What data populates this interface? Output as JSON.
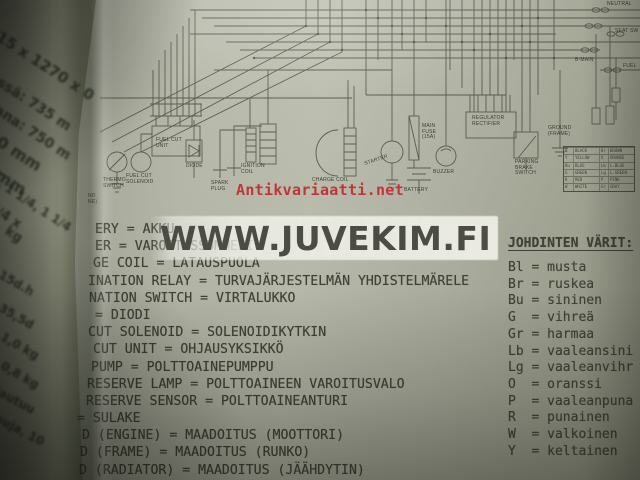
{
  "watermarks": {
    "site_large": "WWW.JUVEKIM.FI",
    "site_red": "Antikvariaatti.net"
  },
  "left_page": {
    "lines": [
      {
        "text": "815 x 1270 x 0",
        "x": -6,
        "y": 22,
        "size": 15,
        "rot": 33
      },
      {
        "text": "dessä: 735 m",
        "x": -14,
        "y": 64,
        "size": 14,
        "rot": 33
      },
      {
        "text": "akana: 750 m",
        "x": -16,
        "y": 92,
        "size": 14,
        "rot": 33
      },
      {
        "text": "90 mm",
        "x": -6,
        "y": 126,
        "size": 16,
        "rot": 33
      },
      {
        "text": "5 mm",
        "x": -12,
        "y": 156,
        "size": 16,
        "rot": 33
      },
      {
        "text": "a, 1 1/4, 1 1/4",
        "x": -4,
        "y": 172,
        "size": 12,
        "rot": 33
      },
      {
        "text": "3/4 x",
        "x": -6,
        "y": 200,
        "size": 13,
        "rot": 33
      },
      {
        "text": "kg",
        "x": 10,
        "y": 224,
        "size": 13,
        "rot": 33
      },
      {
        "text": "ssä: 15d.h",
        "x": -24,
        "y": 252,
        "size": 12,
        "rot": 30
      },
      {
        "text": "ana: 35,5d",
        "x": -26,
        "y": 284,
        "size": 12,
        "rot": 30
      },
      {
        "text": "ssä: 1,0 kg",
        "x": -22,
        "y": 314,
        "size": 12,
        "rot": 30
      },
      {
        "text": "ana: 0,8 kg",
        "x": -24,
        "y": 342,
        "size": 12,
        "rot": 30
      },
      {
        "text": "ostautuu",
        "x": -16,
        "y": 376,
        "size": 12,
        "rot": 28
      },
      {
        "text": "t,muja, 10",
        "x": -14,
        "y": 404,
        "size": 12,
        "rot": 28
      }
    ]
  },
  "diagram": {
    "labels": [
      {
        "text": "THERMO\nSWITCH",
        "x": 103,
        "y": 178
      },
      {
        "text": "FUEL CUT\nSOLENOID",
        "x": 126,
        "y": 174
      },
      {
        "text": "FUEL CUT\nUNIT",
        "x": 156,
        "y": 138
      },
      {
        "text": "DIODE",
        "x": 186,
        "y": 164
      },
      {
        "text": "SPARK\nPLUG",
        "x": 211,
        "y": 181
      },
      {
        "text": "IGNITION\nCOIL",
        "x": 241,
        "y": 164
      },
      {
        "text": "CHARGE COIL",
        "x": 312,
        "y": 178
      },
      {
        "text": "STARTER",
        "x": 364,
        "y": 162,
        "rot": -18
      },
      {
        "text": "MAIN\nFUSE\n(15A)",
        "x": 422,
        "y": 124
      },
      {
        "text": "BUZZER",
        "x": 433,
        "y": 170
      },
      {
        "text": "BATTERY",
        "x": 404,
        "y": 188
      },
      {
        "text": "REGULATOR\nRECTIFIER",
        "x": 472,
        "y": 116
      },
      {
        "text": "PARKING\nBRAKE\nSWITCH",
        "x": 515,
        "y": 160
      },
      {
        "text": "GROUND\n(FRAME)",
        "x": 548,
        "y": 126
      },
      {
        "text": "NEUTRAL",
        "x": 607,
        "y": 2
      },
      {
        "text": "SEAT SW",
        "x": 615,
        "y": 29
      },
      {
        "text": "B-MAIN",
        "x": 575,
        "y": 58
      },
      {
        "text": "FUEL",
        "x": 623,
        "y": 64
      },
      {
        "text": "ND\nNE)",
        "x": 88,
        "y": 194
      }
    ],
    "color_table_rows": [
      [
        "B",
        "BLACK",
        "Br",
        "BROWN"
      ],
      [
        "Y",
        "YELLOW",
        "O",
        "ORANGE"
      ],
      [
        "Bu",
        "BLUE",
        "Lb",
        "L.BLUE"
      ],
      [
        "G",
        "GREEN",
        "Lg",
        "L.GREEN"
      ],
      [
        "R",
        "RED",
        "P",
        "PINK"
      ],
      [
        "W",
        "WHITE",
        "Gr",
        "GRAY"
      ]
    ]
  },
  "translations": {
    "lines": [
      {
        "text": "ERY = AKKU",
        "dx": 95
      },
      {
        "text": "ER = VAROITUSSUMMERI",
        "dx": 95
      },
      {
        "text": "GE COIL = LATAUSPUOLA",
        "dx": 93
      },
      {
        "text": "INATION RELAY = TURVAJÄRJESTELMÄN YHDISTELMÄRELE",
        "dx": 88
      },
      {
        "text": "NATION SWITCH = VIRTALUKKO",
        "dx": 89
      },
      {
        "text": "= DIODI",
        "dx": 95
      },
      {
        "text": "CUT SOLENOID = SOLENOIDIKYTKIN",
        "dx": 88
      },
      {
        "text": "CUT UNIT = OHJAUSYKSIKKÖ",
        "dx": 93
      },
      {
        "text": "PUMP = POLTTOAINEPUMPPU",
        "dx": 91
      },
      {
        "text": "RESERVE LAMP = POLTTOAINEEN VAROITUSVALO",
        "dx": 87
      },
      {
        "text": "RESERVE SENSOR = POLTTOAINEANTURI",
        "dx": 86
      },
      {
        "text": "= SULAKE",
        "dx": 77
      },
      {
        "text": "D (ENGINE) = MAADOITUS (MOOTTORI)",
        "dx": 82
      },
      {
        "text": "D (FRAME) = MAADOITUS (RUNKO)",
        "dx": 80
      },
      {
        "text": "D (RADIATOR) = MAADOITUS (JÄÄHDYTIN)",
        "dx": 79
      }
    ]
  },
  "wire_colors": {
    "heading": "JOHDINTEN VÄRIT:",
    "entries": [
      "Bl = musta",
      "Br = ruskea",
      "Bu = sininen",
      "G  = vihreä",
      "Gr = harmaa",
      "Lb = vaaleansini",
      "Lg = vaaleanvihr",
      "O  = oranssi",
      "P  = vaaleanpuna",
      "R  = punainen",
      "W  = valkoinen",
      "Y  = keltainen"
    ]
  },
  "colors": {
    "paper": "#aaac9c",
    "ink": "#3f4237",
    "red_watermark": "#bf3636",
    "watermark_text": "#4b4d45"
  }
}
